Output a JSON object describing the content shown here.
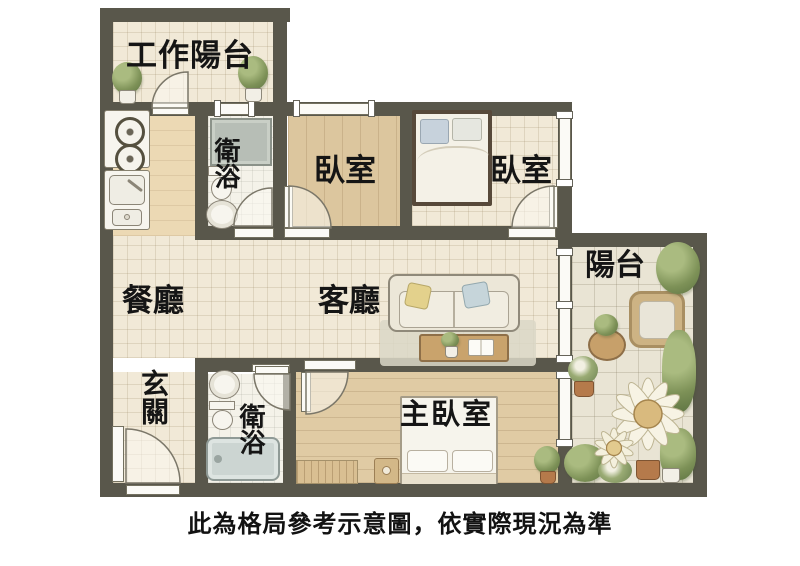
{
  "rooms": {
    "work_balcony": {
      "label": "工作陽台"
    },
    "bathroom_upper": {
      "label": "衛浴"
    },
    "bedroom_left": {
      "label": "臥室"
    },
    "bedroom_right": {
      "label": "臥室"
    },
    "balcony": {
      "label": "陽台"
    },
    "dining": {
      "label": "餐廳"
    },
    "living": {
      "label": "客廳"
    },
    "entry": {
      "label": "玄關"
    },
    "bathroom_lower": {
      "label": "衛浴"
    },
    "master_bedroom": {
      "label": "主臥室"
    }
  },
  "caption": "此為格局參考示意圖，依實際現況為準",
  "colors": {
    "wall": "#59574b",
    "floor_tile": "#f1e9d7",
    "floor_wood": "#dcc69e",
    "floor_stone": "#e9e4d4",
    "plant_green": "#7d9157",
    "label_text": "#151515",
    "background": "#ffffff"
  }
}
